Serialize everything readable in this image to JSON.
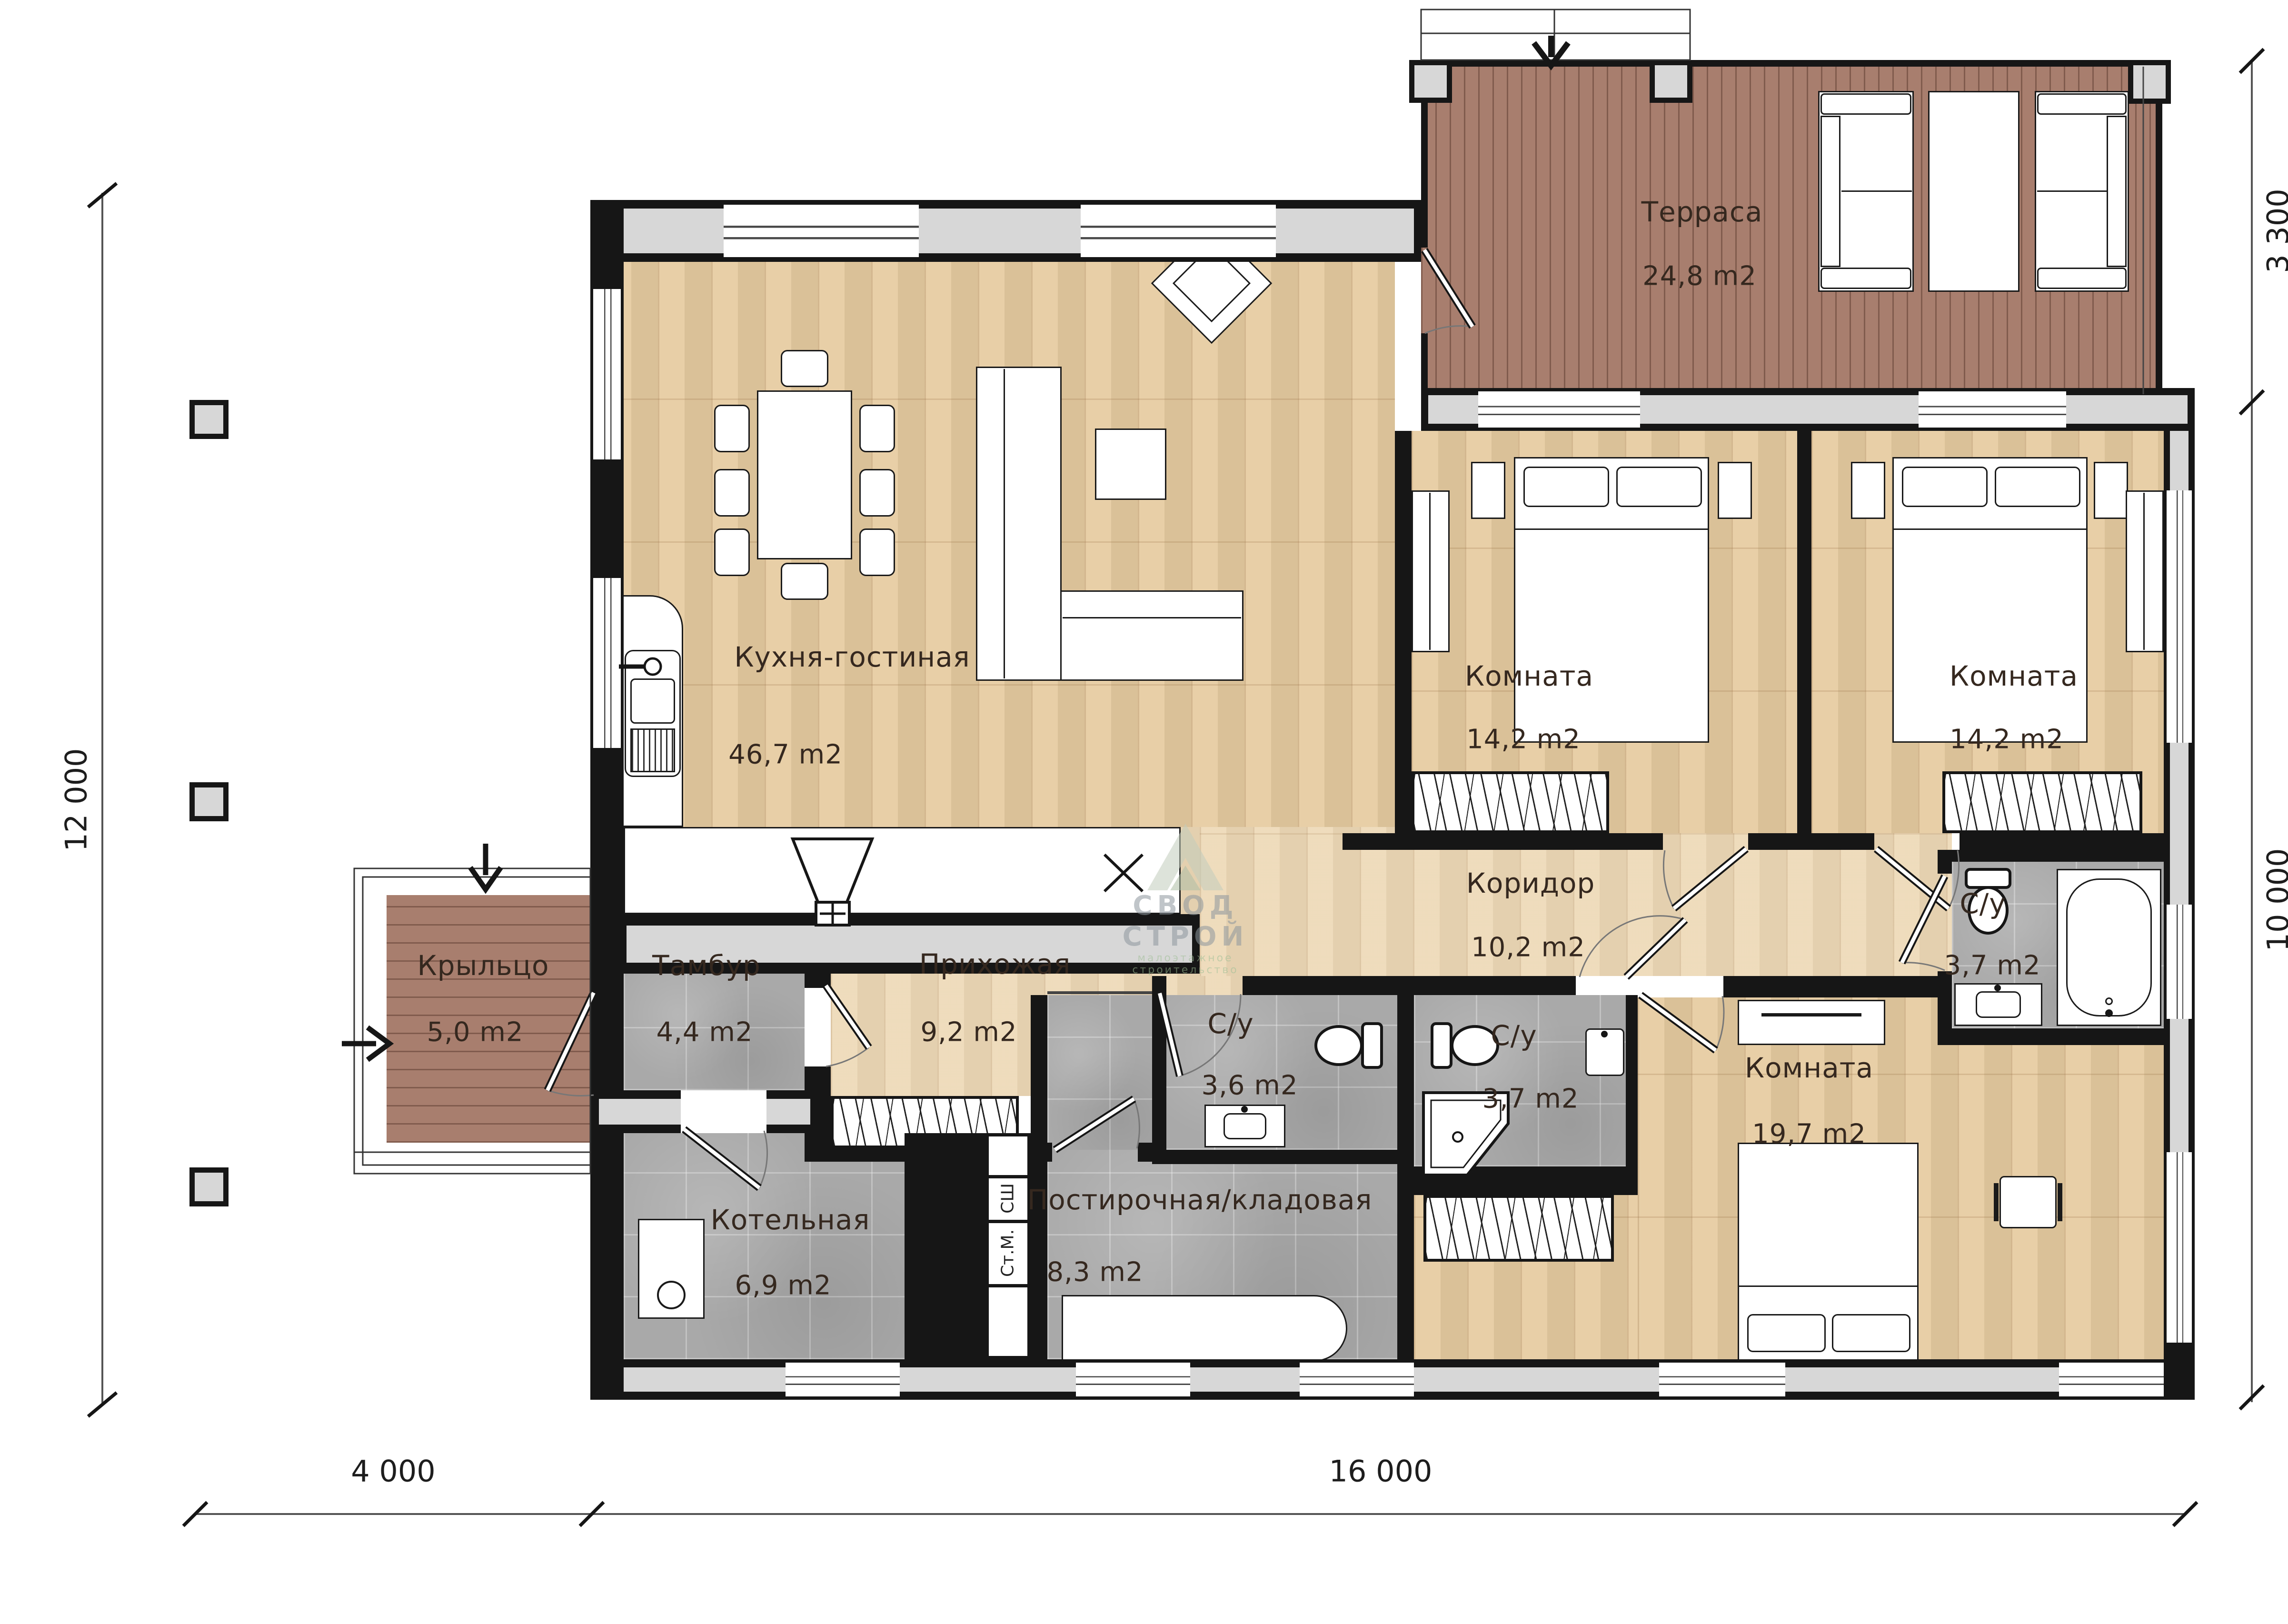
{
  "plan": {
    "rooms": [
      {
        "id": "terrace",
        "name": "Терраса",
        "area": "24,8 m2"
      },
      {
        "id": "kitchen_living",
        "name": "Кухня-гостиная",
        "area": "46,7 m2"
      },
      {
        "id": "bedroom1",
        "name": "Комната",
        "area": "14,2 m2"
      },
      {
        "id": "bedroom2",
        "name": "Комната",
        "area": "14,2 m2"
      },
      {
        "id": "corridor",
        "name": "Коридор",
        "area": "10,2 m2"
      },
      {
        "id": "hallway",
        "name": "Прихожая",
        "area": "9,2 m2"
      },
      {
        "id": "tambour",
        "name": "Тамбур",
        "area": "4,4 m2"
      },
      {
        "id": "porch",
        "name": "Крыльцо",
        "area": "5,0 m2"
      },
      {
        "id": "boiler_room",
        "name": "Котельная",
        "area": "6,9 m2"
      },
      {
        "id": "laundry_storage",
        "name": "Постирочная/кладовая",
        "area": "8,3 m2"
      },
      {
        "id": "wc1",
        "name": "С/у",
        "area": "3,6 m2"
      },
      {
        "id": "wc2",
        "name": "С/у",
        "area": "3,7 m2"
      },
      {
        "id": "wc3",
        "name": "С/у",
        "area": "3,7 m2"
      },
      {
        "id": "bedroom3",
        "name": "Комната",
        "area": "19,7 m2"
      }
    ],
    "closet": {
      "dryer_label": "СШ",
      "washer_label": "Ст.М."
    },
    "marks": {
      "cooktop": "X"
    },
    "dimensions": {
      "left": "12 000",
      "bottom_left": "4 000",
      "bottom_right": "16 000",
      "right_top": "3 300",
      "right_bottom": "10 000"
    },
    "watermark": {
      "line1": "СВОД СТРОЙ",
      "line2": "малоэтажное строительство"
    }
  }
}
